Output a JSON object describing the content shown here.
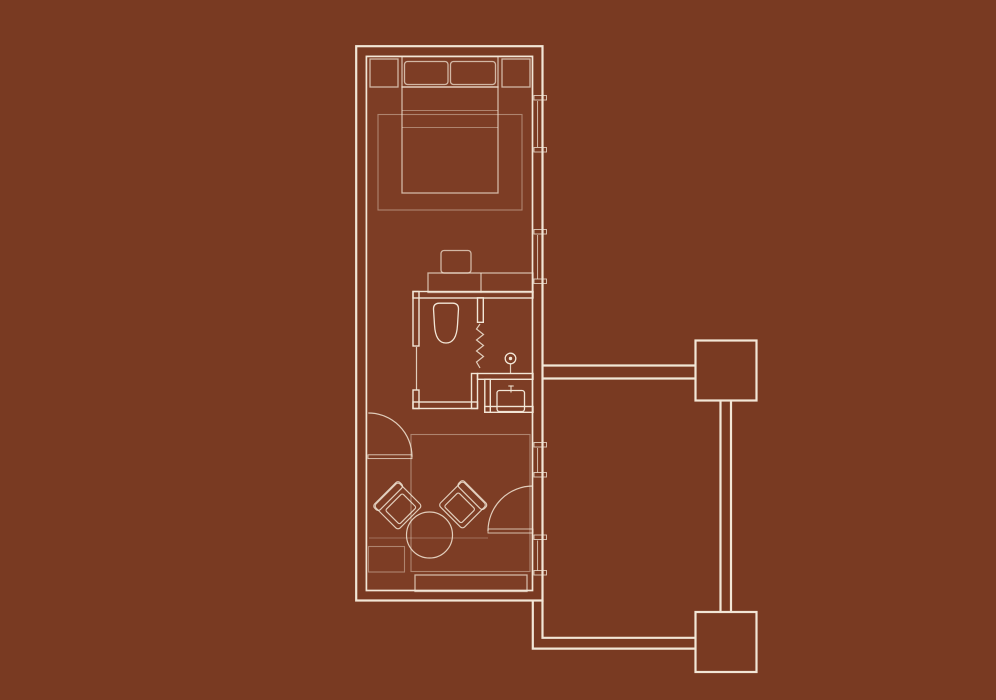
{
  "title": "Hotel suite floor plan drawing on brown background",
  "colors": {
    "background": "#793A22",
    "floor": "#7D3D25",
    "line": "#F2E6D6"
  },
  "plan": {
    "type": "floor-plan",
    "areas": [
      "bedroom",
      "bathroom",
      "vanity-nook",
      "lounge"
    ],
    "furniture": [
      "double-bed",
      "headboard",
      "pillow-left",
      "pillow-right",
      "nightstand-left",
      "nightstand-right",
      "bedroom-rug",
      "desk",
      "desk-chair",
      "cabinet-divider",
      "armchair-left",
      "armchair-right",
      "round-table",
      "ottoman",
      "media-bench",
      "lounge-rug"
    ],
    "fixtures": [
      "toilet",
      "shower-screen-zigzag",
      "shower-head",
      "washbasin",
      "faucet"
    ],
    "openings": [
      "bathroom-sliding-door",
      "lounge-door",
      "entry-door",
      "window-1",
      "window-2",
      "window-3",
      "window-4"
    ],
    "circulation": [
      "upper-corridor",
      "right-corridor",
      "lower-corridor",
      "upper-block",
      "lower-block"
    ]
  }
}
